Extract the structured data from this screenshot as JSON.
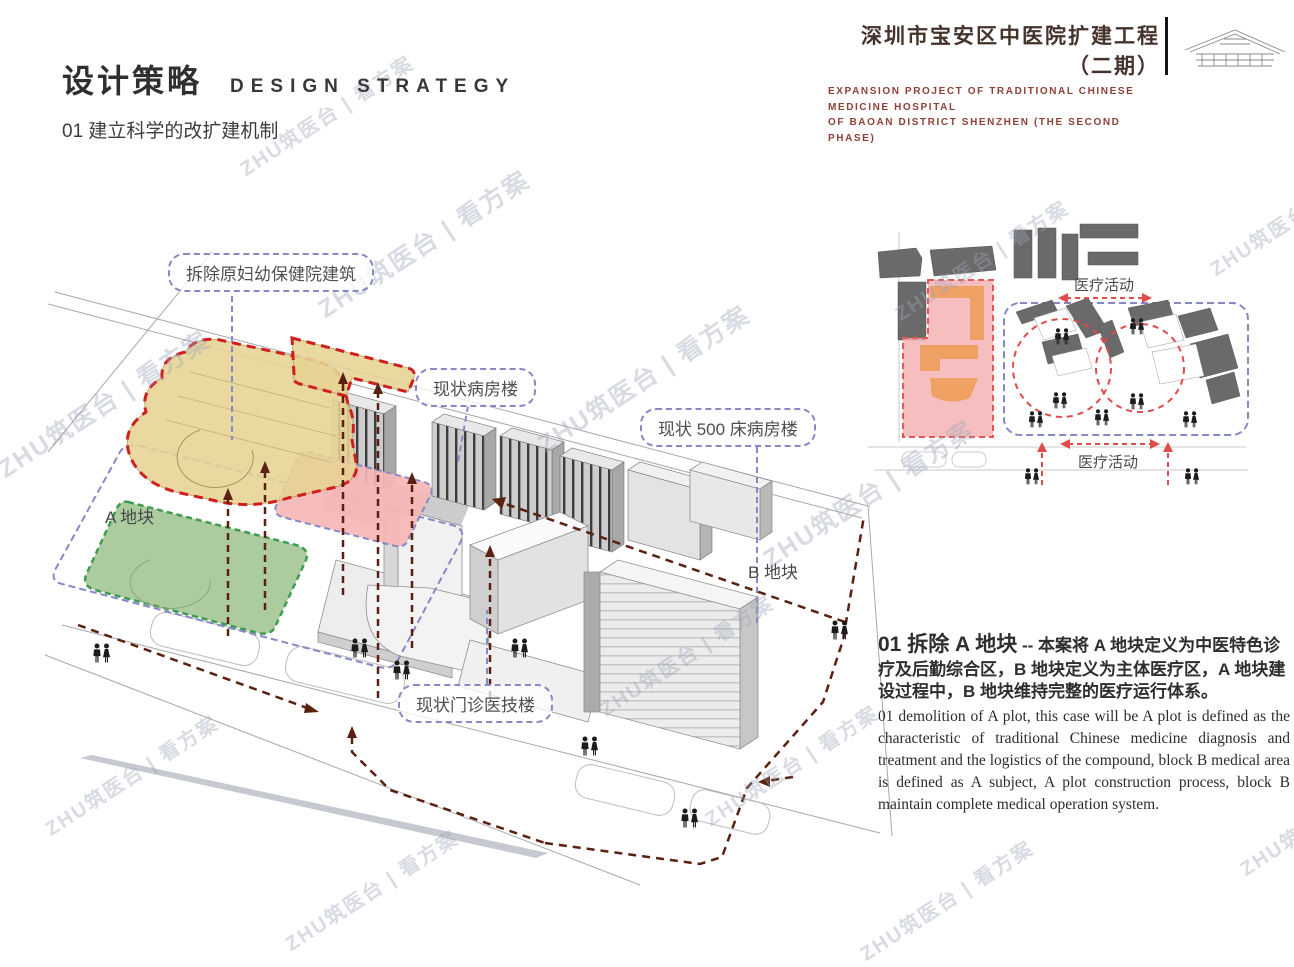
{
  "header": {
    "project_title_cn": "深圳市宝安区中医院扩建工程（二期）",
    "project_subtitle_en_line1": "EXPANSION PROJECT OF TRADITIONAL CHINESE MEDICINE HOSPITAL",
    "project_subtitle_en_line2": "OF BAOAN DISTRICT SHENZHEN (THE SECOND PHASE)",
    "logo_icon": "roof-structure-sketch-icon"
  },
  "section": {
    "title_cn": "设计策略",
    "title_en": "DESIGN STRATEGY",
    "subtitle": "01 建立科学的改扩建机制"
  },
  "site_plan": {
    "callouts": [
      {
        "label": "拆除原妇幼保健院建筑"
      },
      {
        "label": "现状病房楼"
      },
      {
        "label": "现状 500 床病房楼"
      },
      {
        "label": "现状门诊医技楼"
      }
    ],
    "plot_a_label": "A 地块",
    "plot_b_label": "B 地块",
    "people_icon": "person-pair-icon"
  },
  "mini_diagram": {
    "activity_top": "医疗活动",
    "activity_bottom": "医疗活动"
  },
  "description": {
    "heading": "01 拆除 A 地块",
    "separator": "--",
    "body_cn": "本案将 A 地块定义为中医特色诊疗及后勤综合区，B 地块定义为主体医疗区，A 地块建设过程中，B 地块维持完整的医疗运行体系。",
    "body_en": "01 demolition of A plot, this case will be A plot is defined as the characteristic of traditional Chinese medicine diagnosis and treatment and the logistics of the compound, block B medical area is defined as A subject, A plot construction process, block B maintain complete medical operation system."
  },
  "watermark": {
    "text": "ZHU筑医台 | 看方案"
  },
  "colors": {
    "title_brown": "#45322b",
    "subtitle_red": "#8e4136",
    "demolish_red_dash": "#cf1f1f",
    "callout_blue": "#8689c6",
    "route_maroon": "#5a2110",
    "plot_pink": "#f6b6b6",
    "plot_green": "#accb9f",
    "plot_yellow": "#e7d494",
    "mini_red": "#e04b4b",
    "mini_orange": "#efa063",
    "building_dark_gray": "#6a6a6a"
  }
}
